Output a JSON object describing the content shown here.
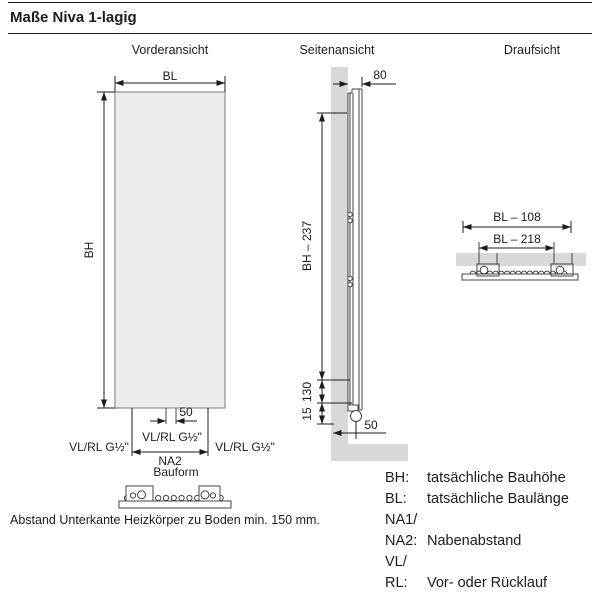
{
  "page": {
    "title": "Maße Niva 1-lagig",
    "note": "Abstand Unterkante Heizkörper zu Boden min. 150 mm."
  },
  "views": {
    "front": {
      "title": "Vorderansicht",
      "dim_bl": "BL",
      "dim_bh": "BH",
      "dim_50": "50",
      "dim_na2": "NA2",
      "conn_label": "VL/RL G½\"",
      "bauform_label": "Bauform"
    },
    "side": {
      "title": "Seitenansicht",
      "dim_depth": "80",
      "dim_height": "BH – 237",
      "dim_130": "130",
      "dim_15": "15",
      "dim_50": "50"
    },
    "top": {
      "title": "Draufsicht",
      "dim_outer": "BL – 108",
      "dim_inner": "BL – 218"
    }
  },
  "legend": {
    "items": [
      {
        "key": "BH:",
        "value": "tatsächliche Bauhöhe"
      },
      {
        "key": "BL:",
        "value": "tatsächliche Baulänge"
      },
      {
        "key": "NA1/",
        "value": ""
      },
      {
        "key": "NA2:",
        "value": "Nabenabstand"
      },
      {
        "key": "VL/",
        "value": ""
      },
      {
        "key": "RL:",
        "value": "Vor- oder Rücklauf"
      }
    ]
  },
  "colors": {
    "wall": "#d8d8d8",
    "panel": "#ececec",
    "outline": "#444444",
    "dimension": "#1d1d1d"
  }
}
